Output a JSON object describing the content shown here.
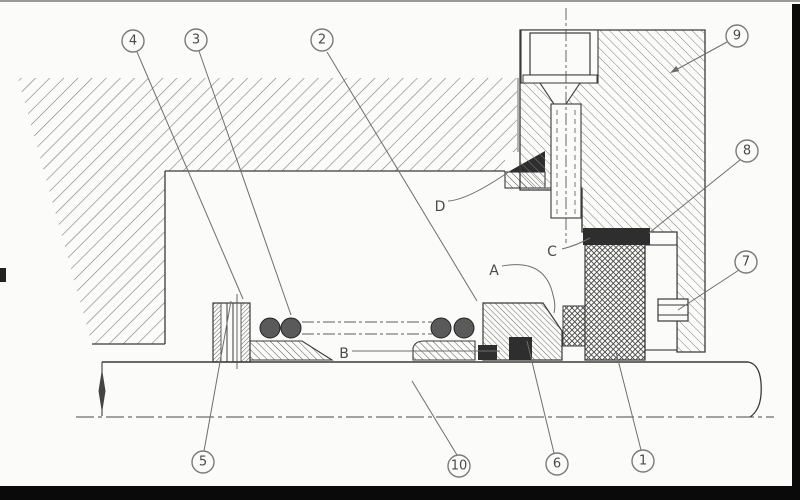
{
  "figure": {
    "callouts": [
      {
        "label": "4",
        "x": 133,
        "y": 41
      },
      {
        "label": "3",
        "x": 196,
        "y": 40
      },
      {
        "label": "2",
        "x": 322,
        "y": 40
      },
      {
        "label": "9",
        "x": 737,
        "y": 36
      },
      {
        "label": "8",
        "x": 747,
        "y": 151
      },
      {
        "label": "7",
        "x": 746,
        "y": 262
      },
      {
        "label": "5",
        "x": 203,
        "y": 462
      },
      {
        "label": "10",
        "x": 459,
        "y": 466
      },
      {
        "label": "6",
        "x": 557,
        "y": 464
      },
      {
        "label": "1",
        "x": 643,
        "y": 461
      }
    ],
    "letters": [
      {
        "label": "D",
        "x": 440,
        "y": 207
      },
      {
        "label": "C",
        "x": 552,
        "y": 252
      },
      {
        "label": "A",
        "x": 494,
        "y": 271
      },
      {
        "label": "B",
        "x": 344,
        "y": 354
      }
    ],
    "colors": {
      "line": "#3a3a3a",
      "label": "#4a4a4a",
      "dark_fill": "#2e2e2e",
      "frame": "#0a0a0a",
      "background": "#fbfbfa"
    }
  }
}
